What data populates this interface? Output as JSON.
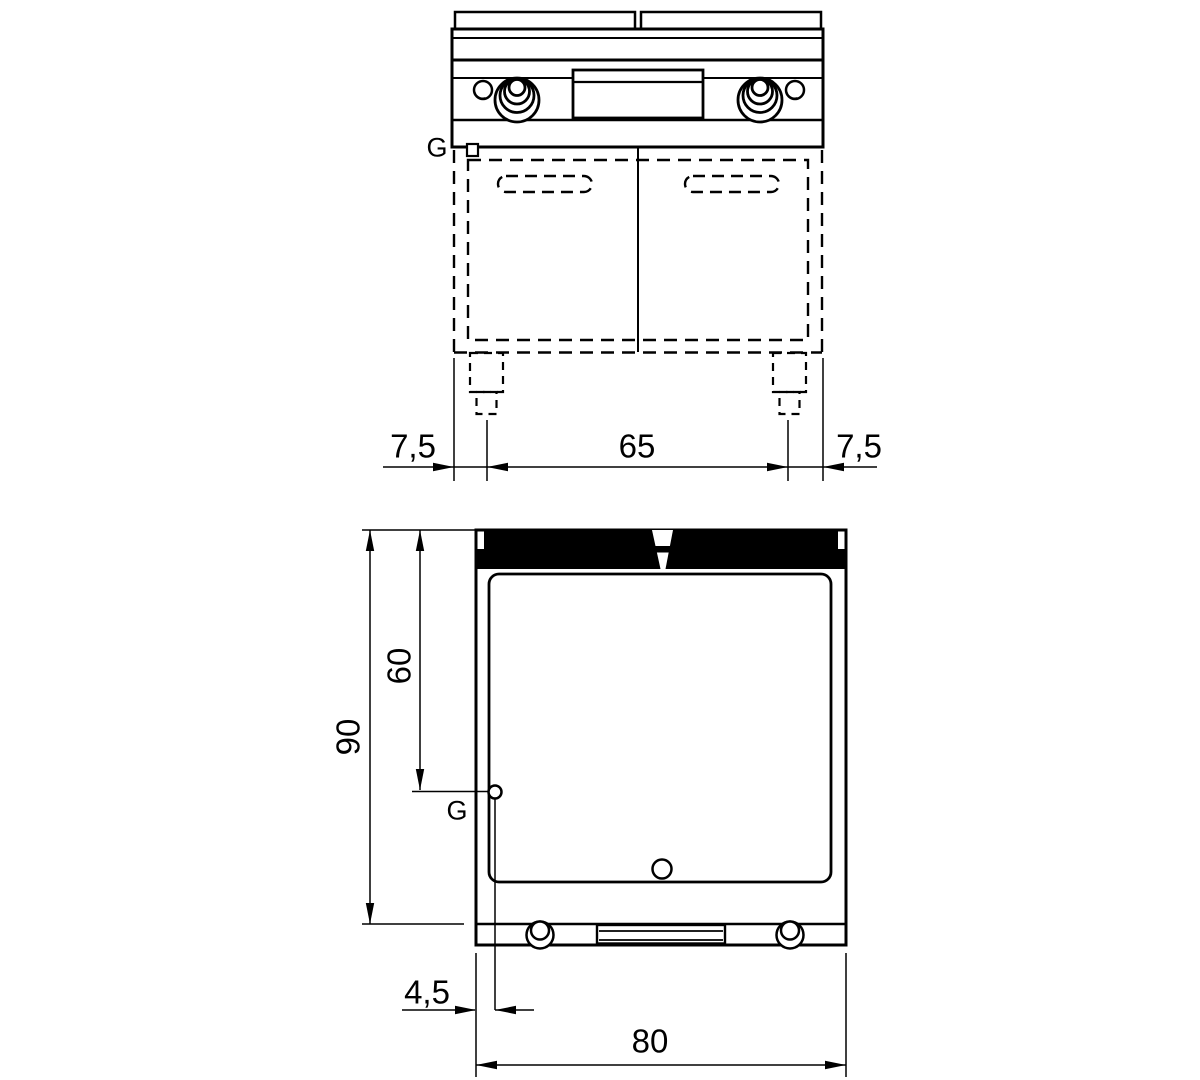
{
  "meta": {
    "drawing_type": "technical-dimension-drawing",
    "background": "#ffffff",
    "line_color": "#000000"
  },
  "front_view": {
    "gas_connection_label": "G",
    "dimensions": {
      "left_offset": "7,5",
      "leg_spacing": "65",
      "right_offset": "7,5"
    }
  },
  "plan_view": {
    "gas_connection_label": "G",
    "dimensions": {
      "total_depth": "90",
      "gas_depth": "60",
      "gas_side_offset": "4,5",
      "total_width": "80"
    }
  }
}
